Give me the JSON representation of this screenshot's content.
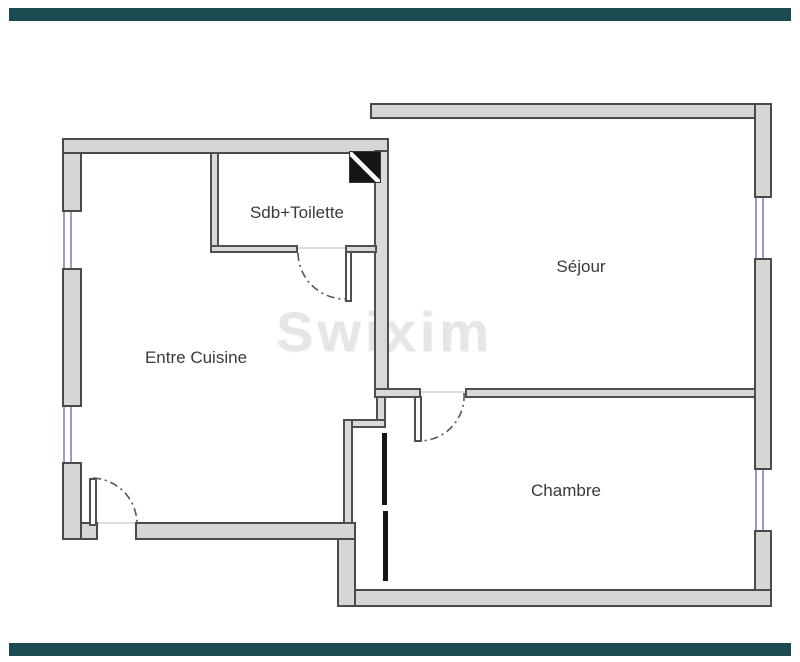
{
  "brand": {
    "bar_color": "#1b4a50",
    "watermark_text": "Swixim"
  },
  "floorplan": {
    "rooms": [
      {
        "id": "sdb-toilette",
        "label": "Sdb+Toilette"
      },
      {
        "id": "sejour",
        "label": "Séjour"
      },
      {
        "id": "entre-cuisine",
        "label": "Entre Cuisine"
      },
      {
        "id": "chambre",
        "label": "Chambre"
      }
    ],
    "colors": {
      "wall_fill": "#d6d6d6",
      "wall_outline": "#4a4a4a",
      "window_line": "#9b9bc9",
      "door_arc": "#555555",
      "shaft_black": "#161616",
      "watermark": "#e6e6e6",
      "label_text": "#3a3a3a"
    }
  }
}
